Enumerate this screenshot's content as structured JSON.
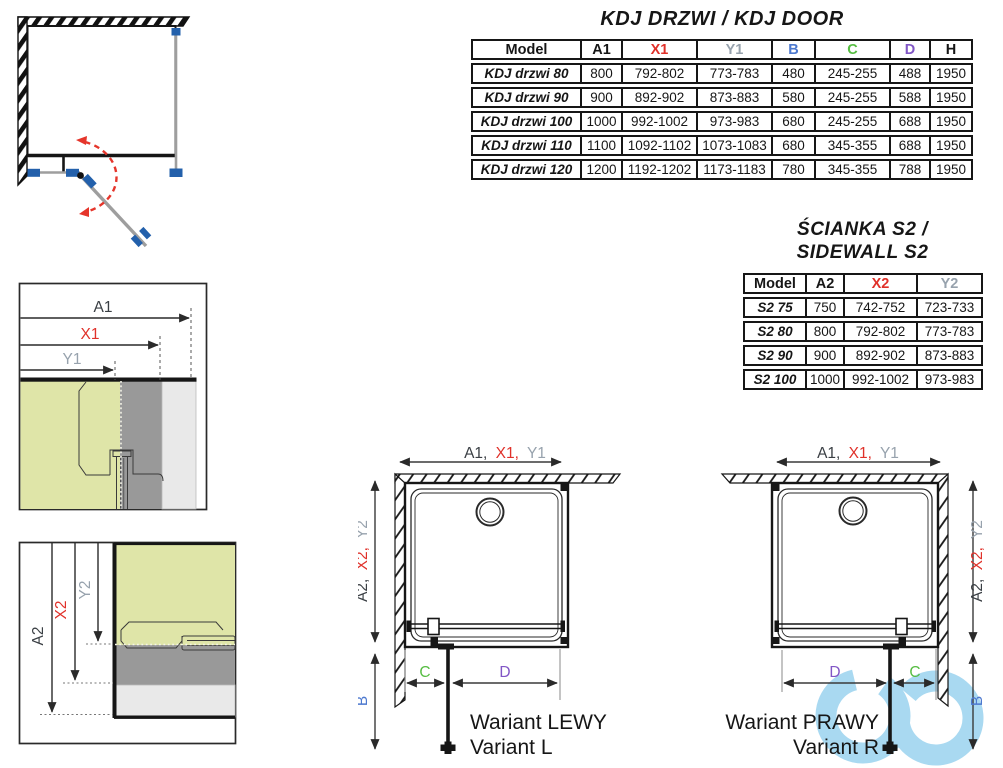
{
  "kdj_table": {
    "title": "KDJ DRZWI / KDJ DOOR",
    "headers": [
      "Model",
      "A1",
      "X1",
      "Y1",
      "B",
      "C",
      "D",
      "H"
    ],
    "rows": [
      {
        "model": "KDJ drzwi 80",
        "a1": "800",
        "x1": "792-802",
        "y1": "773-783",
        "b": "480",
        "c": "245-255",
        "d": "488",
        "h": "1950"
      },
      {
        "model": "KDJ drzwi 90",
        "a1": "900",
        "x1": "892-902",
        "y1": "873-883",
        "b": "580",
        "c": "245-255",
        "d": "588",
        "h": "1950"
      },
      {
        "model": "KDJ drzwi 100",
        "a1": "1000",
        "x1": "992-1002",
        "y1": "973-983",
        "b": "680",
        "c": "245-255",
        "d": "688",
        "h": "1950"
      },
      {
        "model": "KDJ drzwi 110",
        "a1": "1100",
        "x1": "1092-1102",
        "y1": "1073-1083",
        "b": "680",
        "c": "345-355",
        "d": "688",
        "h": "1950"
      },
      {
        "model": "KDJ drzwi 120",
        "a1": "1200",
        "x1": "1192-1202",
        "y1": "1173-1183",
        "b": "780",
        "c": "345-355",
        "d": "788",
        "h": "1950"
      }
    ]
  },
  "s2_table": {
    "title_line1": "ŚCIANKA S2 /",
    "title_line2": "SIDEWALL S2",
    "headers": [
      "Model",
      "A2",
      "X2",
      "Y2"
    ],
    "rows": [
      {
        "model": "S2 75",
        "a2": "750",
        "x2": "742-752",
        "y2": "723-733"
      },
      {
        "model": "S2 80",
        "a2": "800",
        "x2": "792-802",
        "y2": "773-783"
      },
      {
        "model": "S2 90",
        "a2": "900",
        "x2": "892-902",
        "y2": "873-883"
      },
      {
        "model": "S2 100",
        "a2": "1000",
        "x2": "992-1002",
        "y2": "973-983"
      }
    ]
  },
  "diagram_labels": {
    "a1": "A1",
    "x1": "X1",
    "y1": "Y1",
    "a2": "A2",
    "x2": "X2",
    "y2": "Y2",
    "b": "B",
    "c": "C",
    "d": "D",
    "combo_h": [
      "A1,",
      "X1,",
      "Y1"
    ],
    "combo_v": [
      "A2,",
      "X2,",
      "Y2"
    ]
  },
  "variant_left": {
    "title": "Wariant LEWY",
    "subtitle": "Variant L"
  },
  "variant_right": {
    "title": "Wariant PRAWY",
    "subtitle": "Variant R"
  },
  "colors": {
    "dimension_red": "#e0312a",
    "dimension_gray": "#97a2ad",
    "dimension_blue": "#4d79cf",
    "dimension_green": "#56bd42",
    "dimension_purple": "#8156c6",
    "hardware_blue": "#2360ab",
    "swing_arc_red": "#e5352b",
    "glass_green": "#dfe5a8",
    "profile_dark_gray": "#999999",
    "wall_light_gray": "#e9e9e9",
    "watermark_blue": "#a9d9f1"
  },
  "icons": {
    "watermark": "brand-watermark-icon"
  }
}
